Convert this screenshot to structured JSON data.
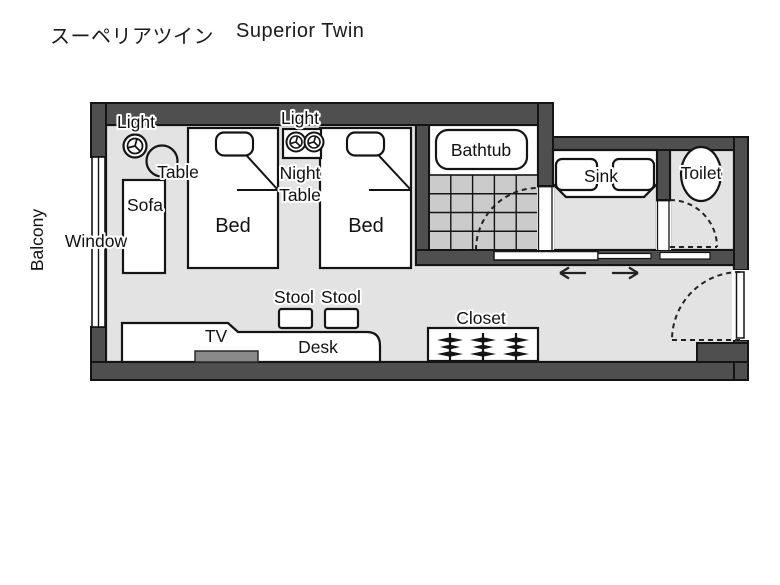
{
  "title": {
    "japanese": "スーペリアツイン",
    "english": "Superior Twin"
  },
  "room_labels": {
    "balcony": "Balcony",
    "window": "Window",
    "light_left": "Light",
    "light_center": "Light",
    "table": "Table",
    "sofa": "Sofa",
    "bed_left": "Bed",
    "bed_right": "Bed",
    "night_table_line1": "Night",
    "night_table_line2": "Table",
    "bathtub": "Bathtub",
    "sink": "Sink",
    "toilet": "Toilet",
    "stool_left": "Stool",
    "stool_right": "Stool",
    "closet": "Closet",
    "tv": "TV",
    "desk": "Desk"
  },
  "icons": {
    "lamp_icon": "ceiling-light symbol (double circle with 3 spokes)",
    "hanger_icon": "clothes-hanger stack",
    "slide_left_arrow": "←",
    "slide_right_arrow": "→",
    "door_swing_icon": "dashed quarter-circle door swing",
    "window_icon": "double-line window in wall"
  },
  "colors": {
    "wall": "#4f4f4f",
    "outline": "#141414",
    "floor": "#e3e3e3",
    "tile": "#cbcbcb",
    "tv_fill": "#8a8a8a",
    "background": "#ffffff"
  }
}
